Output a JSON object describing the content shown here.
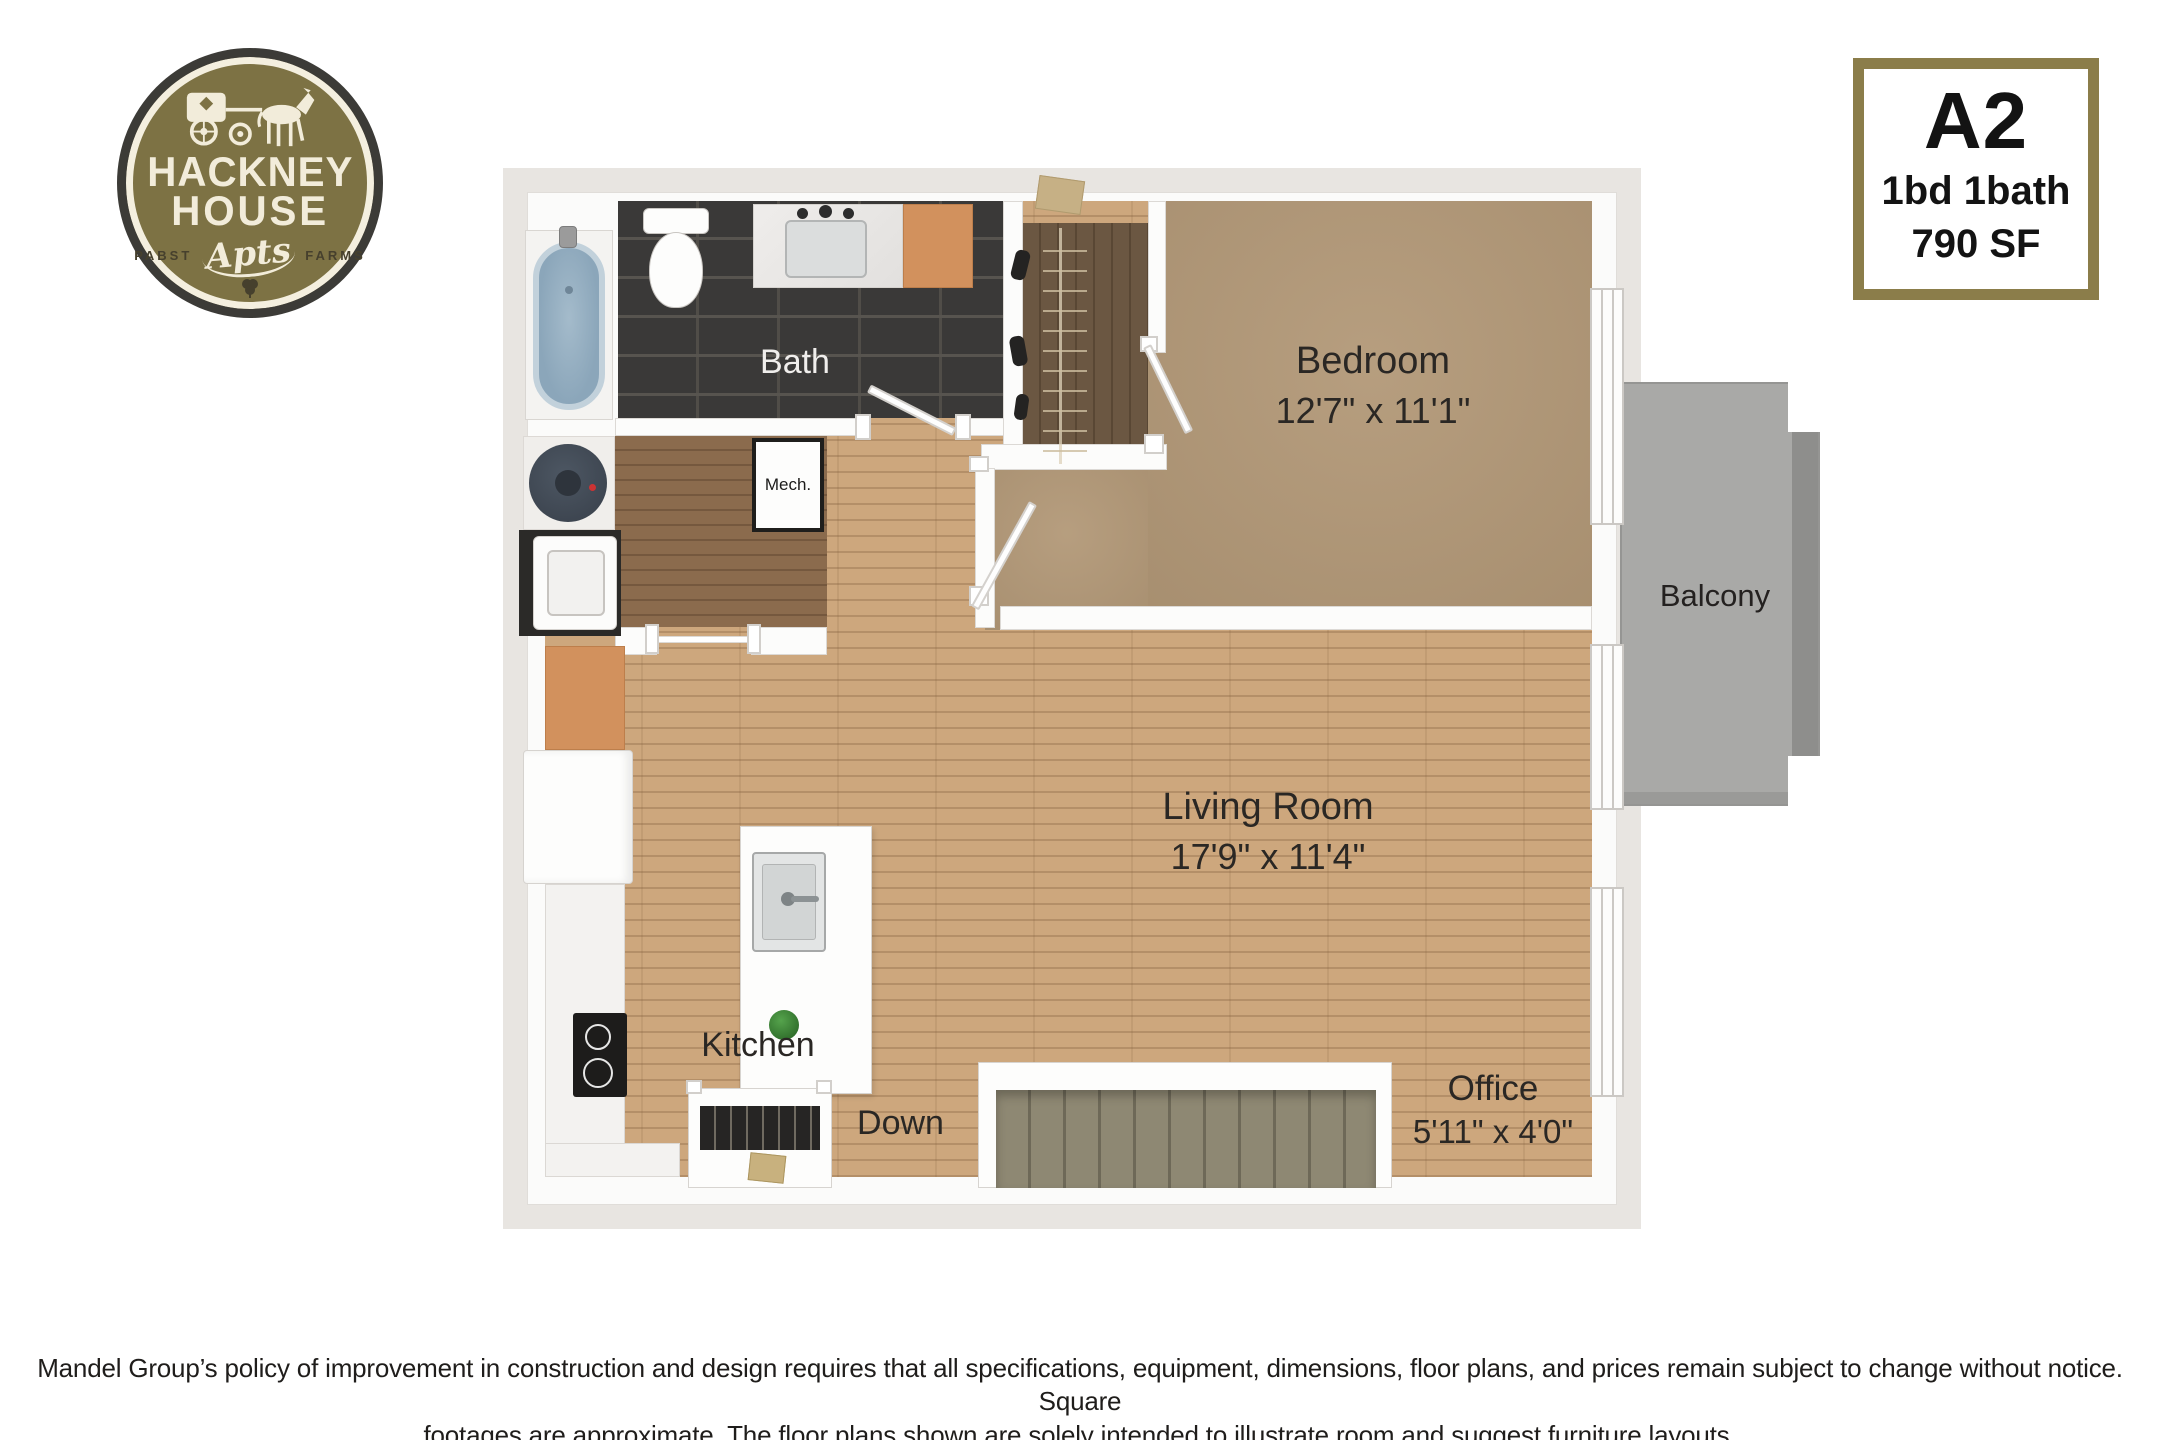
{
  "logo": {
    "name_line1": "HACKNEY",
    "name_line2": "HOUSE",
    "sub_left": "PABST",
    "sub_script": "Apts",
    "sub_right": "FARMS"
  },
  "unit_card": {
    "unit": "A2",
    "beds_baths": "1bd 1bath",
    "area": "790 SF"
  },
  "rooms": {
    "bath": {
      "label": "Bath"
    },
    "mech": {
      "label": "Mech."
    },
    "bedroom": {
      "label": "Bedroom",
      "dims": "12'7\" x 11'1\""
    },
    "living_room": {
      "label": "Living Room",
      "dims": "17'9\" x 11'4\""
    },
    "kitchen": {
      "label": "Kitchen"
    },
    "stairs": {
      "label": "Down"
    },
    "office": {
      "label": "Office",
      "dims": "5'11\" x 4'0\""
    },
    "balcony": {
      "label": "Balcony"
    }
  },
  "disclaimer": {
    "line1": "Mandel Group’s policy of improvement in construction and design requires that all specifications, equipment, dimensions, floor plans, and prices remain subject to change without notice. Square",
    "line2": "footages are approximate. The floor plans shown are solely intended to illustrate room and suggest furniture layouts."
  },
  "colors": {
    "logo_olive": "#7d7244",
    "logo_ring": "#3c3b37",
    "logo_cream": "#f2ecda",
    "card_border": "#8b7d4a",
    "wood_light": "#cda77d",
    "wood_dark_hall": "#8b6b4d",
    "carpet": "#b29877",
    "closet_floor": "#6b5742",
    "bath_tile": "#3a3938",
    "balcony_concrete": "#a9a9a7",
    "stairs_carpet": "#8e8873",
    "cabinet_orange": "#d2915d",
    "tub_blue": "#8ba6ba",
    "label_text": "#2a2724"
  }
}
